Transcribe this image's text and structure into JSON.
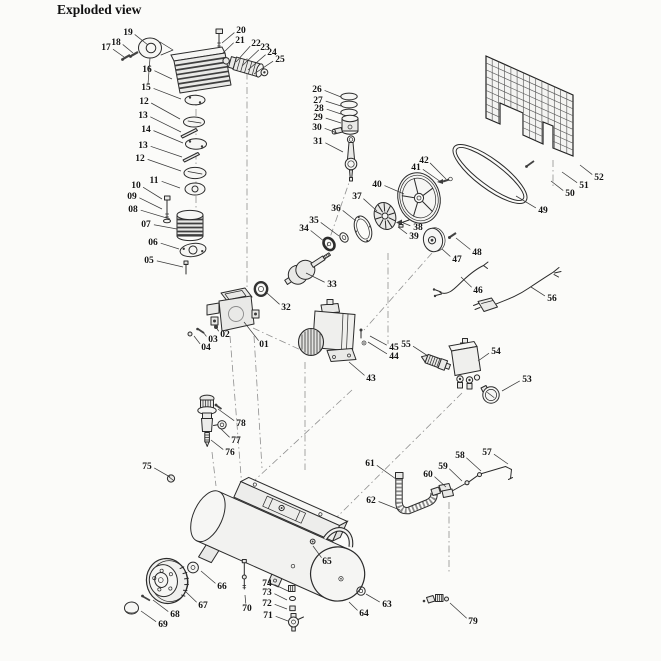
{
  "title": "Exploded view",
  "canvas": {
    "bg": "#fbfbf9",
    "ink": "#2b2b2b",
    "label_color": "#141414",
    "leader_color": "#3a3a3a",
    "phantom_color": "#8f8f8f"
  },
  "part_labels": [
    {
      "t": "19",
      "x": 128,
      "y": 32,
      "lx": 148,
      "ly": 45
    },
    {
      "t": "18",
      "x": 116,
      "y": 42,
      "lx": 133,
      "ly": 53
    },
    {
      "t": "17",
      "x": 106,
      "y": 47,
      "lx": 124,
      "ly": 57
    },
    {
      "t": "16",
      "x": 147,
      "y": 69,
      "lx": 172,
      "ly": 79
    },
    {
      "t": "15",
      "x": 146,
      "y": 87,
      "lx": 181,
      "ly": 99
    },
    {
      "t": "12",
      "x": 144,
      "y": 101,
      "lx": 180,
      "ly": 119
    },
    {
      "t": "13",
      "x": 143,
      "y": 115,
      "lx": 181,
      "ly": 132
    },
    {
      "t": "14",
      "x": 146,
      "y": 129,
      "lx": 183,
      "ly": 143
    },
    {
      "t": "13",
      "x": 143,
      "y": 145,
      "lx": 182,
      "ly": 157
    },
    {
      "t": "12",
      "x": 140,
      "y": 158,
      "lx": 181,
      "ly": 171
    },
    {
      "t": "11",
      "x": 154,
      "y": 180,
      "lx": 180,
      "ly": 188
    },
    {
      "t": "10",
      "x": 136,
      "y": 185,
      "lx": 162,
      "ly": 199
    },
    {
      "t": "09",
      "x": 132,
      "y": 196,
      "lx": 162,
      "ly": 209
    },
    {
      "t": "08",
      "x": 133,
      "y": 209,
      "lx": 170,
      "ly": 219
    },
    {
      "t": "07",
      "x": 146,
      "y": 224,
      "lx": 177,
      "ly": 229
    },
    {
      "t": "06",
      "x": 153,
      "y": 242,
      "lx": 179,
      "ly": 249
    },
    {
      "t": "05",
      "x": 149,
      "y": 260,
      "lx": 183,
      "ly": 267
    },
    {
      "t": "20",
      "x": 241,
      "y": 30,
      "lx": 222,
      "ly": 43
    },
    {
      "t": "21",
      "x": 240,
      "y": 40,
      "lx": 223,
      "ly": 53
    },
    {
      "t": "22",
      "x": 256,
      "y": 43,
      "lx": 236,
      "ly": 62
    },
    {
      "t": "23",
      "x": 265,
      "y": 47,
      "lx": 242,
      "ly": 66
    },
    {
      "t": "24",
      "x": 272,
      "y": 52,
      "lx": 248,
      "ly": 70
    },
    {
      "t": "25",
      "x": 280,
      "y": 59,
      "lx": 254,
      "ly": 74
    },
    {
      "t": "26",
      "x": 317,
      "y": 89,
      "lx": 341,
      "ly": 97
    },
    {
      "t": "27",
      "x": 318,
      "y": 100,
      "lx": 341,
      "ly": 106
    },
    {
      "t": "28",
      "x": 319,
      "y": 108,
      "lx": 341,
      "ly": 114
    },
    {
      "t": "29",
      "x": 318,
      "y": 117,
      "lx": 341,
      "ly": 123
    },
    {
      "t": "30",
      "x": 317,
      "y": 127,
      "lx": 337,
      "ly": 133
    },
    {
      "t": "31",
      "x": 318,
      "y": 141,
      "lx": 343,
      "ly": 152
    },
    {
      "t": "42",
      "x": 424,
      "y": 160,
      "lx": 446,
      "ly": 179
    },
    {
      "t": "41",
      "x": 416,
      "y": 167,
      "lx": 441,
      "ly": 182
    },
    {
      "t": "40",
      "x": 377,
      "y": 184,
      "lx": 404,
      "ly": 194
    },
    {
      "t": "37",
      "x": 357,
      "y": 196,
      "lx": 377,
      "ly": 211
    },
    {
      "t": "36",
      "x": 336,
      "y": 208,
      "lx": 356,
      "ly": 221
    },
    {
      "t": "35",
      "x": 314,
      "y": 220,
      "lx": 339,
      "ly": 236
    },
    {
      "t": "34",
      "x": 304,
      "y": 228,
      "lx": 325,
      "ly": 242
    },
    {
      "t": "38",
      "x": 418,
      "y": 227,
      "lx": 401,
      "ly": 222
    },
    {
      "t": "39",
      "x": 414,
      "y": 236,
      "lx": 398,
      "ly": 227
    },
    {
      "t": "33",
      "x": 332,
      "y": 284,
      "lx": 306,
      "ly": 273
    },
    {
      "t": "32",
      "x": 286,
      "y": 307,
      "lx": 267,
      "ly": 293
    },
    {
      "t": "47",
      "x": 457,
      "y": 259,
      "lx": 442,
      "ly": 249
    },
    {
      "t": "48",
      "x": 477,
      "y": 252,
      "lx": 456,
      "ly": 238
    },
    {
      "t": "49",
      "x": 543,
      "y": 210,
      "lx": 516,
      "ly": 196
    },
    {
      "t": "50",
      "x": 570,
      "y": 193,
      "lx": 551,
      "ly": 181
    },
    {
      "t": "51",
      "x": 584,
      "y": 185,
      "lx": 562,
      "ly": 172
    },
    {
      "t": "52",
      "x": 599,
      "y": 177,
      "lx": 580,
      "ly": 165
    },
    {
      "t": "46",
      "x": 478,
      "y": 290,
      "lx": 461,
      "ly": 277
    },
    {
      "t": "56",
      "x": 552,
      "y": 298,
      "lx": 531,
      "ly": 287
    },
    {
      "t": "01",
      "x": 264,
      "y": 344,
      "lx": 244,
      "ly": 322
    },
    {
      "t": "02",
      "x": 225,
      "y": 334,
      "lx": 216,
      "ly": 327
    },
    {
      "t": "03",
      "x": 213,
      "y": 339,
      "lx": 203,
      "ly": 332
    },
    {
      "t": "04",
      "x": 206,
      "y": 347,
      "lx": 194,
      "ly": 336
    },
    {
      "t": "43",
      "x": 371,
      "y": 378,
      "lx": 349,
      "ly": 362
    },
    {
      "t": "44",
      "x": 394,
      "y": 356,
      "lx": 368,
      "ly": 342
    },
    {
      "t": "45",
      "x": 394,
      "y": 347,
      "lx": 370,
      "ly": 336
    },
    {
      "t": "55",
      "x": 406,
      "y": 344,
      "lx": 428,
      "ly": 356
    },
    {
      "t": "54",
      "x": 496,
      "y": 351,
      "lx": 478,
      "ly": 361
    },
    {
      "t": "53",
      "x": 527,
      "y": 379,
      "lx": 502,
      "ly": 391
    },
    {
      "t": "57",
      "x": 487,
      "y": 452,
      "lx": 508,
      "ly": 464
    },
    {
      "t": "58",
      "x": 460,
      "y": 455,
      "lx": 481,
      "ly": 471
    },
    {
      "t": "59",
      "x": 443,
      "y": 466,
      "lx": 462,
      "ly": 481
    },
    {
      "t": "60",
      "x": 428,
      "y": 474,
      "lx": 446,
      "ly": 487
    },
    {
      "t": "61",
      "x": 370,
      "y": 463,
      "lx": 396,
      "ly": 479
    },
    {
      "t": "62",
      "x": 371,
      "y": 500,
      "lx": 400,
      "ly": 510
    },
    {
      "t": "75",
      "x": 147,
      "y": 466,
      "lx": 170,
      "ly": 477
    },
    {
      "t": "76",
      "x": 230,
      "y": 452,
      "lx": 211,
      "ly": 440
    },
    {
      "t": "77",
      "x": 236,
      "y": 440,
      "lx": 220,
      "ly": 428
    },
    {
      "t": "78",
      "x": 241,
      "y": 423,
      "lx": 218,
      "ly": 409
    },
    {
      "t": "65",
      "x": 327,
      "y": 561,
      "lx": 313,
      "ly": 546
    },
    {
      "t": "64",
      "x": 364,
      "y": 613,
      "lx": 349,
      "ly": 602
    },
    {
      "t": "63",
      "x": 387,
      "y": 604,
      "lx": 366,
      "ly": 594
    },
    {
      "t": "79",
      "x": 473,
      "y": 621,
      "lx": 450,
      "ly": 603
    },
    {
      "t": "66",
      "x": 222,
      "y": 586,
      "lx": 201,
      "ly": 571
    },
    {
      "t": "67",
      "x": 203,
      "y": 605,
      "lx": 186,
      "ly": 592
    },
    {
      "t": "68",
      "x": 175,
      "y": 614,
      "lx": 153,
      "ly": 600
    },
    {
      "t": "69",
      "x": 163,
      "y": 624,
      "lx": 141,
      "ly": 611
    },
    {
      "t": "70",
      "x": 247,
      "y": 608,
      "lx": 245,
      "ly": 595
    },
    {
      "t": "71",
      "x": 268,
      "y": 615,
      "lx": 288,
      "ly": 621
    },
    {
      "t": "72",
      "x": 267,
      "y": 603,
      "lx": 287,
      "ly": 609
    },
    {
      "t": "73",
      "x": 267,
      "y": 592,
      "lx": 287,
      "ly": 600
    },
    {
      "t": "74",
      "x": 267,
      "y": 583,
      "lx": 288,
      "ly": 591
    }
  ],
  "phantom_lines": [
    [
      196,
      80,
      196,
      208
    ],
    [
      247,
      58,
      247,
      288
    ],
    [
      230,
      336,
      242,
      488
    ],
    [
      254,
      336,
      262,
      468
    ],
    [
      352,
      390,
      242,
      492
    ],
    [
      462,
      393,
      332,
      522
    ],
    [
      449,
      502,
      449,
      574
    ],
    [
      388,
      253,
      388,
      344
    ],
    [
      352,
      174,
      325,
      252
    ],
    [
      253,
      328,
      303,
      351
    ],
    [
      553,
      160,
      553,
      186
    ],
    [
      212,
      452,
      216,
      486
    ],
    [
      305,
      362,
      305,
      470
    ],
    [
      432,
      253,
      364,
      330
    ]
  ]
}
